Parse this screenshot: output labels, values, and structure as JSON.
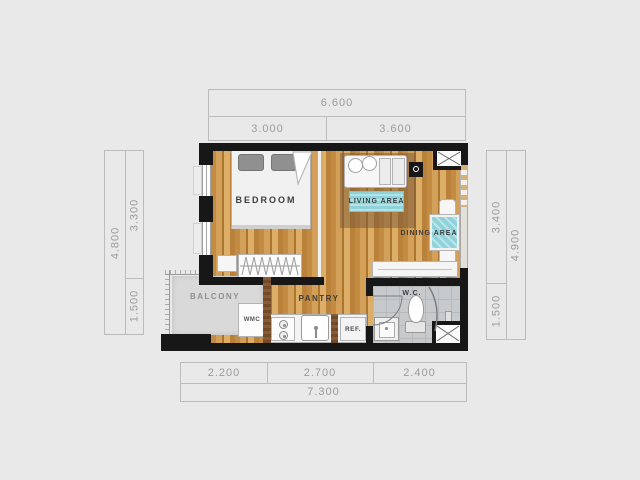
{
  "dimensions": {
    "top": {
      "total": "6.600",
      "segments": [
        "3.000",
        "3.600"
      ]
    },
    "bottom": {
      "total": "7.300",
      "segments": [
        "2.200",
        "2.700",
        "2.400"
      ]
    },
    "left": {
      "total": "4.800",
      "segments": [
        "3.300",
        "1.500"
      ]
    },
    "right": {
      "total": "4.900",
      "segments": [
        "3.400",
        "1.500"
      ]
    }
  },
  "rooms": {
    "bedroom": "BEDROOM",
    "living_area": "LIVING AREA",
    "dining_area": "DINING AREA",
    "pantry": "PANTRY",
    "balcony": "BALCONY",
    "wc": "W.C."
  },
  "appliances": {
    "washing_machine": "WMC",
    "refrigerator": "REF."
  },
  "colors": {
    "background": "#e9e9e9",
    "walls": "#171717",
    "wood_floor": "#c99a52",
    "balcony_floor": "#d9d9d9",
    "wc_floor": "#c7cacc",
    "rug_teal": "#8ed2da",
    "dimension_text": "#9b9b9b"
  }
}
